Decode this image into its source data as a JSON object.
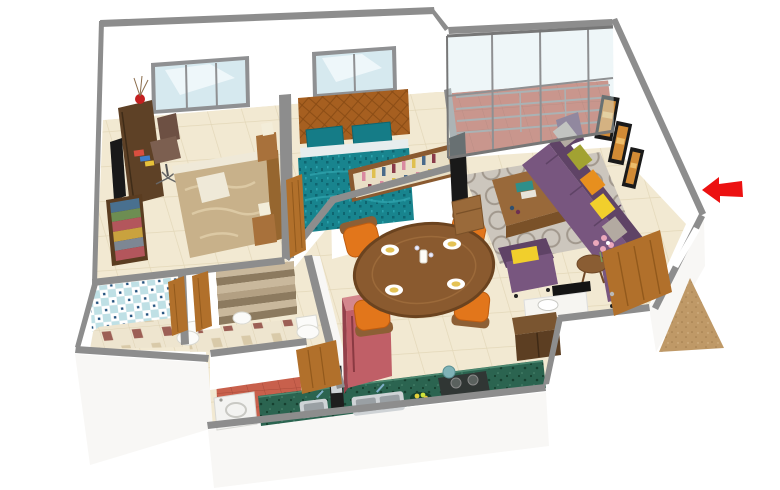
{
  "rooms": [
    "bedroom",
    "master-bedroom",
    "living-room",
    "balcony",
    "dining-area",
    "kitchen",
    "bathroom-1",
    "bathroom-2",
    "utility-area",
    "entrance"
  ],
  "icons": {
    "entrance_direction_arrow": "arrow-left"
  },
  "colors": {
    "wall_cap": "#8d8d8d",
    "wall_cap_dark": "#6e6e6e",
    "wall_face": "#ffffff",
    "wall_face_shade": "#f8f7f5",
    "floor": "#f2e9d2",
    "floor_line": "#e3d7b8",
    "balcony_floor": "#bf5b48",
    "balcony_line": "#a84a39",
    "bath_floor": "#eee5cf",
    "bath_floor_accent": "#9c5f55",
    "bath_floor_accent2": "#d9caa9",
    "bath_tile": "#bfe0e5",
    "bath_tile_dot": "#23527e",
    "utility_floor": "#c8604c",
    "glass": "#d6e9ef",
    "window_frame": "#8f9092",
    "curtain": "#f4fafc",
    "wood_door": "#b1702b",
    "wood_door_dark": "#7e4b13",
    "desk_wood": "#5e4126",
    "wardrobe_wood": "#5a3c20",
    "clothes1": "#49708f",
    "clothes2": "#6d8d52",
    "clothes3": "#b3565c",
    "clothes4": "#c9a23e",
    "clothes5": "#7d8793",
    "bed2_blanket": "#c8b18a",
    "bed2_fold": "#dcc9a4",
    "bed2_sheet": "#efe9d8",
    "bed_frame_wood": "#96662f",
    "bed_teal": "#18848e",
    "bed_teal_dark": "#0e6570",
    "headboard": "#a65f20",
    "headboard_line": "#7e440f",
    "pillow_teal": "#157c87",
    "lamp_shade": "#f3edd9",
    "nightstand": "#a8713b",
    "chair_desk": "#6d5043",
    "sofa": "#78567f",
    "sofa_dark": "#5f4366",
    "cushion_gray": "#b3aaa1",
    "cushion_olive": "#a2a232",
    "cushion_orange": "#e78f1e",
    "cushion_yellow": "#f1cf2c",
    "rug": "#ccc6bd",
    "rug_ring": "#a1988d",
    "coffee_table": "#99693a",
    "coffee_table_dark": "#7a5128",
    "art_frame": "#1a1a1a",
    "art_fill": "#d28b35",
    "art_light": "#edbd6b",
    "tv_black": "#191919",
    "dining_table": "#8a5a2f",
    "dining_table_dark": "#6b431f",
    "plate": "#ffffff",
    "napkin": "#e4c255",
    "chair_orange": "#e2761b",
    "chair_orange_dark": "#bf5c10",
    "chair_wood": "#8d5f35",
    "fridge_front": "#c05f67",
    "fridge_side": "#93414b",
    "fridge_top": "#d4878d",
    "counter_green": "#2b6450",
    "counter_green_dark": "#16402f",
    "sink_steel": "#cfd3d6",
    "sink_steel_dark": "#9aa0a4",
    "faucet": "#7fb0c9",
    "stove": "#303634",
    "burner": "#5a615e",
    "kettle": "#7fb3b7",
    "washing_machine": "#f3f3f1",
    "toilet": "#fbfbf9",
    "toilet_shade": "#d9d9d2",
    "shoe_cabinet": "#5c3e22",
    "shoe_cabinet_top": "#7a5530",
    "basin_counter": "#f6f5f1",
    "mirror": "#141414",
    "mat": "#bf9967",
    "mat_dark": "#a07c4c",
    "arrow": "#ec1111",
    "flower_pink": "#eba8bb",
    "flower_green": "#7d9a5a",
    "stripe_a": "#c9b89c",
    "stripe_b": "#8c7a5f",
    "stripe_c": "#b3a083",
    "vase_red": "#c42020",
    "twig": "#8a6b4a",
    "book_a": "#d94f3f",
    "book_b": "#3f7dc9",
    "book_c": "#e8c23a",
    "bottle_a": "#d98aa0",
    "bottle_b": "#e0c04e",
    "bottle_c": "#4a6a8a",
    "bottle_d": "#8a3a4a",
    "shelf_wood": "#8a5a30",
    "shelf_bg": "#e9dfc6"
  }
}
